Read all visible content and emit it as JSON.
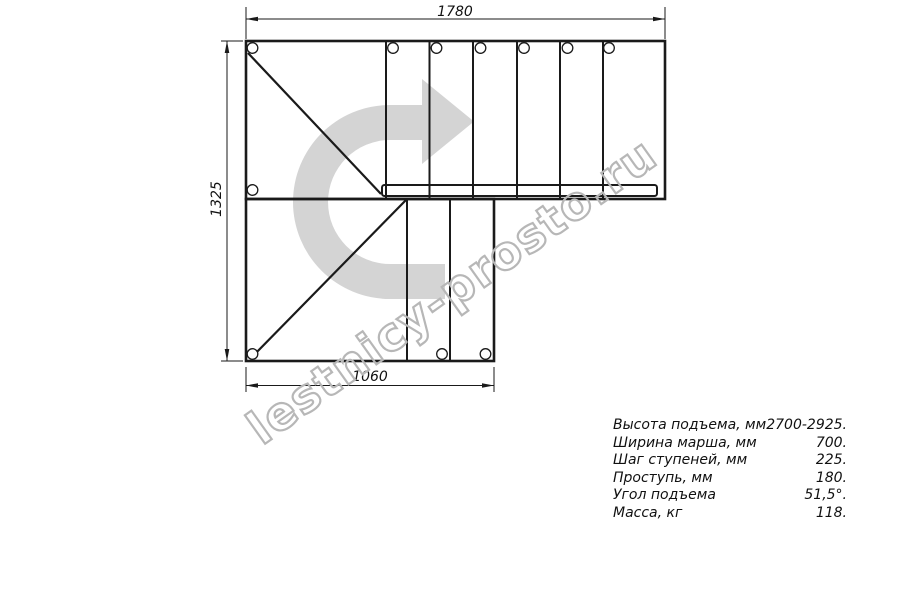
{
  "watermark": {
    "text": "lestnicy-prosto.ru"
  },
  "drawing": {
    "title": "Stair plan view (U-turn staircase)",
    "dim_top": "1780",
    "dim_left": "1325",
    "dim_bottom": "1060"
  },
  "specs": {
    "rows": [
      {
        "label": "Высота подъема, мм",
        "value": "2700-2925."
      },
      {
        "label": "Ширина марша, мм",
        "value": "700."
      },
      {
        "label": "Шаг ступеней, мм",
        "value": "225."
      },
      {
        "label": "Проступь, мм",
        "value": "180."
      },
      {
        "label": "Угол подъема",
        "value": "51,5°."
      },
      {
        "label": "Масса, кг",
        "value": "118."
      }
    ]
  },
  "colors": {
    "line": "#1a1a1a",
    "arrow_fill": "#d4d4d4",
    "watermark_stroke": "#b7b7b7"
  }
}
